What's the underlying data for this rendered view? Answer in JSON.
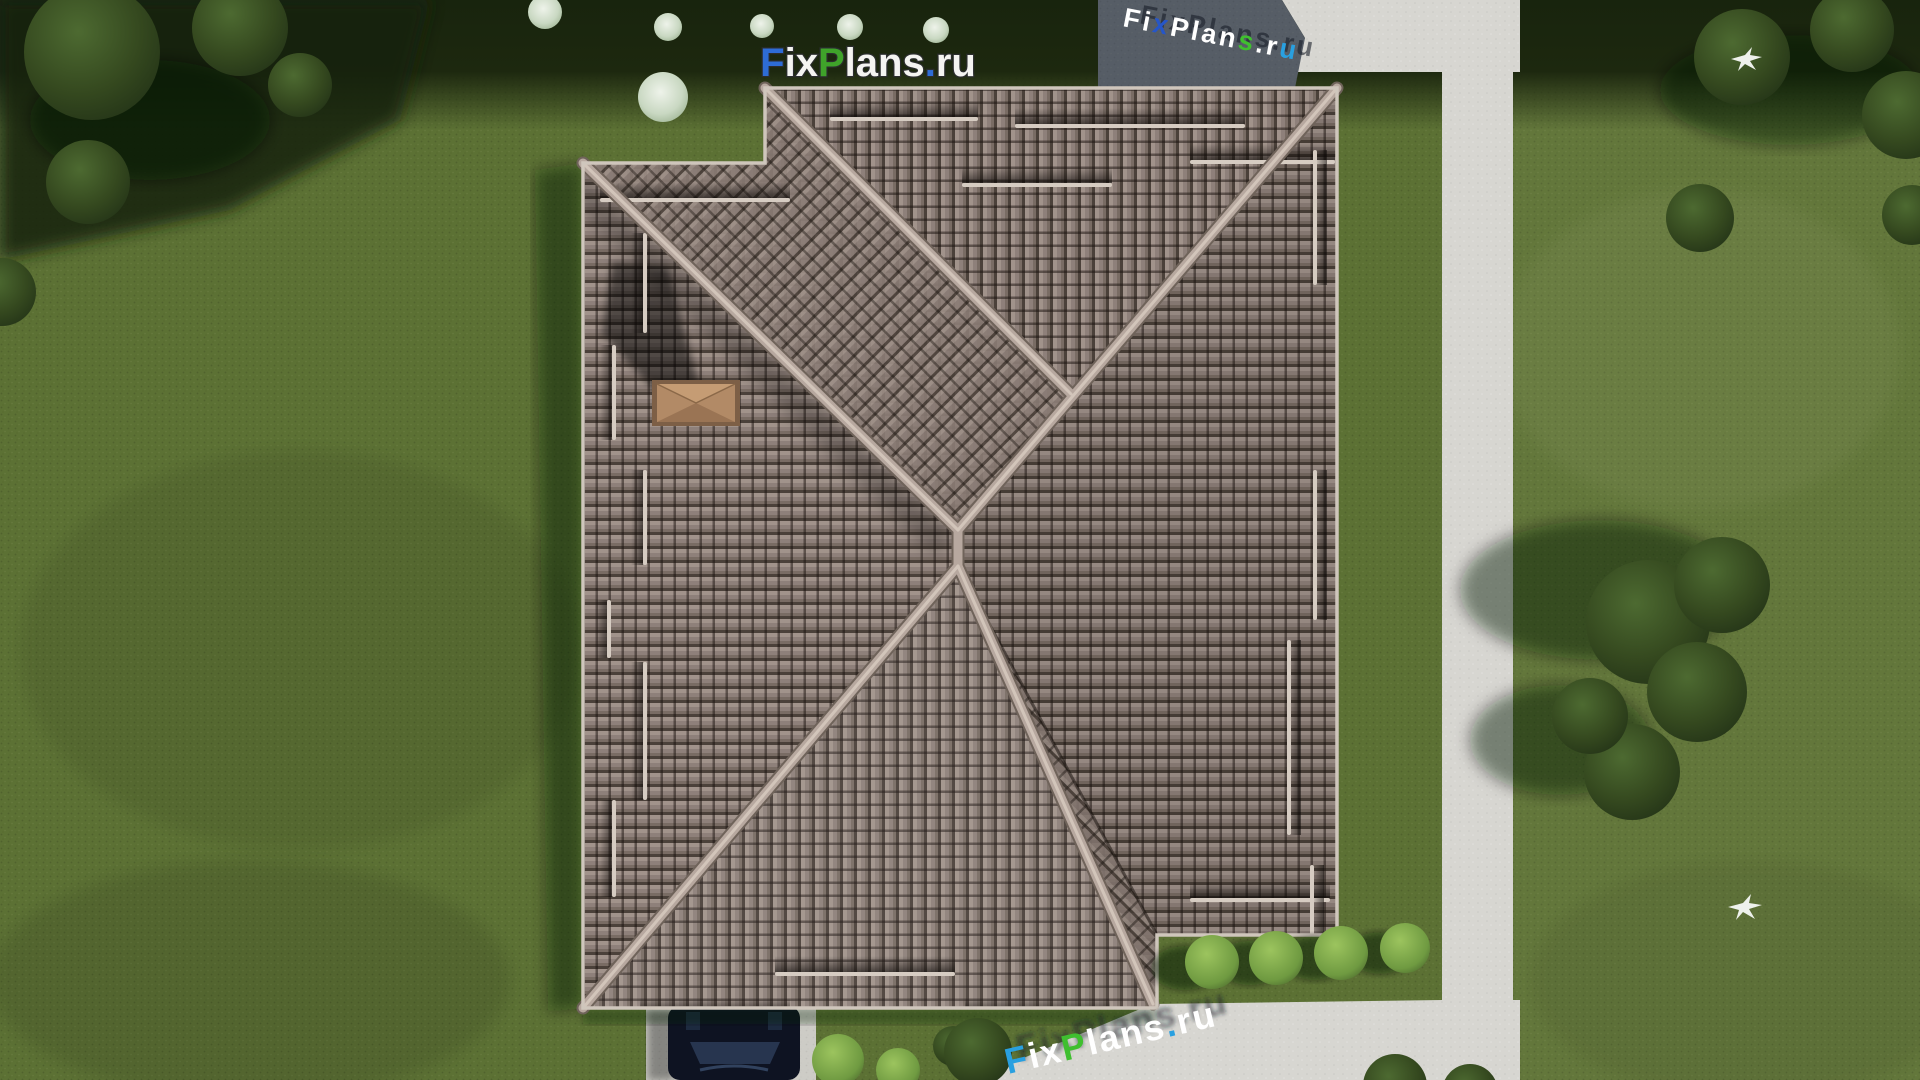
{
  "watermarks": {
    "brand": "FixPlans.ru",
    "logo_top": {
      "segments": [
        {
          "text": "F",
          "color": "#2e6cd6"
        },
        {
          "text": "ix",
          "color": "#f4f4f1"
        },
        {
          "text": "P",
          "color": "#3fa32a"
        },
        {
          "text": "lans",
          "color": "#f4f4f1"
        },
        {
          "text": ".",
          "color": "#2e6cd6"
        },
        {
          "text": "ru",
          "color": "#f4f4f1"
        }
      ]
    },
    "ground_bottom": {
      "segments": [
        {
          "text": "F",
          "color": "#29a0e0"
        },
        {
          "text": "ix",
          "color": "#ffffff"
        },
        {
          "text": "P",
          "color": "#3fbf2f"
        },
        {
          "text": "lans",
          "color": "#ffffff"
        },
        {
          "text": ".",
          "color": "#29a0e0"
        },
        {
          "text": "ru",
          "color": "#ffffff"
        }
      ]
    },
    "ground_top": {
      "segments": [
        {
          "text": "Fi",
          "color": "#ffffff"
        },
        {
          "text": "x",
          "color": "#2656c8"
        },
        {
          "text": "Plan",
          "color": "#ffffff"
        },
        {
          "text": "s",
          "color": "#3fbf2f"
        },
        {
          "text": ".r",
          "color": "#ffffff"
        },
        {
          "text": "u",
          "color": "#29a0e0"
        }
      ]
    }
  },
  "scene": {
    "description": "Aerial top-down 3D render of a house hip roof plan with landscaped yard",
    "palette": {
      "lawn": "#5c7134",
      "lawn_dark_top": "#1d280f",
      "roof_tile": "#8d7f78",
      "roof_groove": "#40372f",
      "ridge_cap": "#b7a89f",
      "walkway": "#d7d6d1",
      "patio_shadowed": "#555c66",
      "chimney": "#b28a66",
      "car": "#0e1322",
      "tree_canopy": "#32471f",
      "light_bush": "#84b04f",
      "flowering_shrub": "#e4ecdf"
    },
    "objects": {
      "building": "hip-roof house with brown tile roof, ridge caps, snow guards and chimney",
      "vehicle": "dark sedan on concrete driveway",
      "landscape": [
        "lawn",
        "trees",
        "flowering shrubs",
        "trimmed bushes",
        "L-shaped walkway",
        "patio",
        "driveway"
      ],
      "wildlife": "two flying birds"
    }
  }
}
